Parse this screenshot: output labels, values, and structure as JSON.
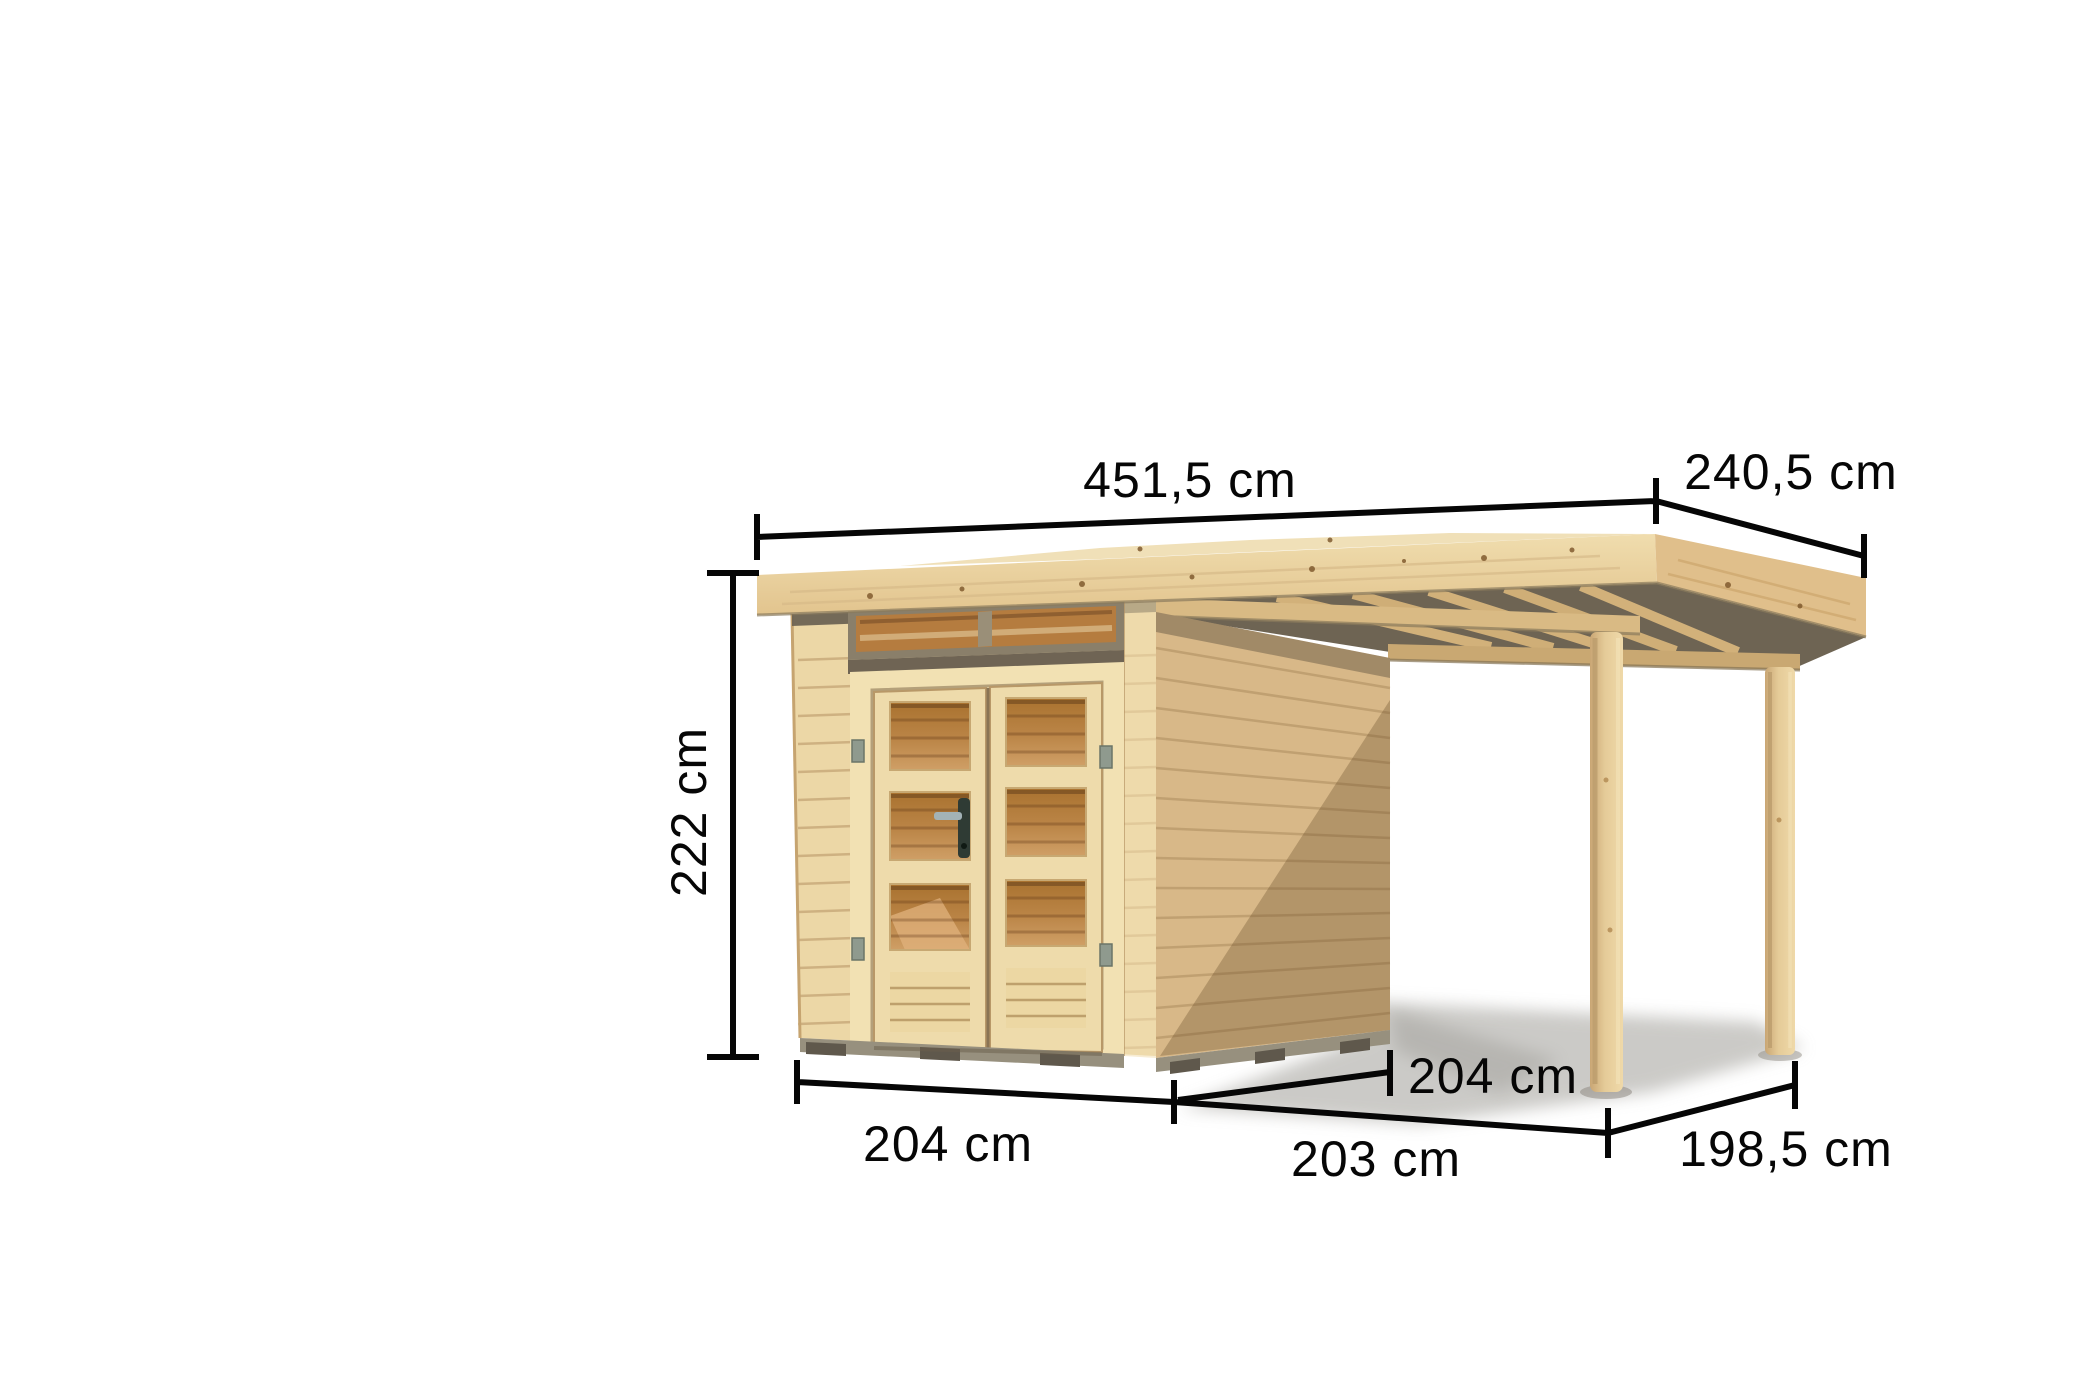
{
  "illustration": {
    "product": "garden-shed-with-side-canopy",
    "dimensions": {
      "roof_width": "451,5 cm",
      "roof_depth": "240,5 cm",
      "wall_height": "222 cm",
      "shed_front_width": "204 cm",
      "annex_front_width": "203 cm",
      "shed_side_depth": "204 cm",
      "annex_side_depth": "198,5 cm"
    },
    "colors": {
      "background": "#ffffff",
      "wood_light": "#f0e0b8",
      "wood_mid": "#e9d2a0",
      "wood_side_wall": "#d8b888",
      "glass_amber": "#b57c3f",
      "soffit_dark": "#6e6453",
      "foundation_gray": "#97907e",
      "dimension_line": "#060606"
    }
  }
}
